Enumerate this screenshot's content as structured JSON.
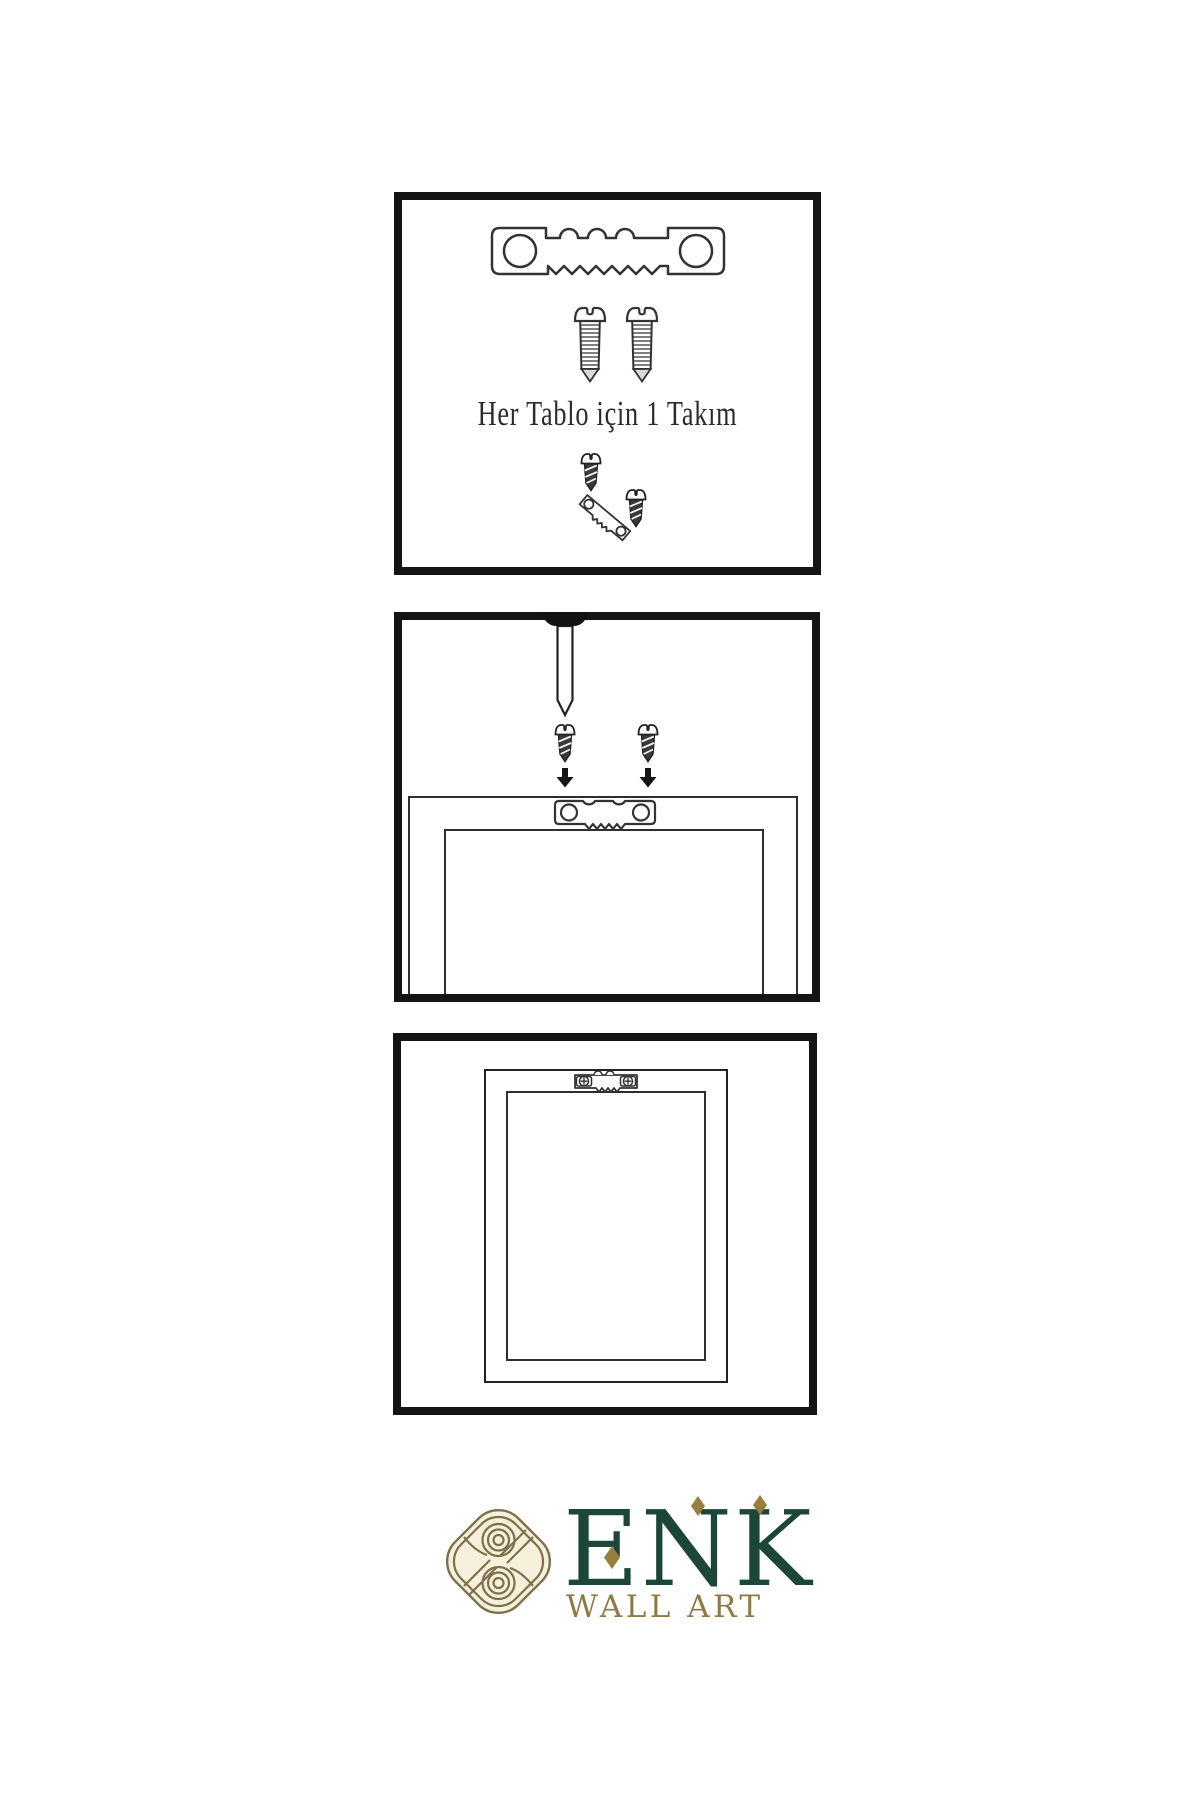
{
  "page": {
    "background": "#ffffff"
  },
  "colors": {
    "outline": "#333333",
    "panel_border": "#141414",
    "dark_fill": "#3a3a3a",
    "text": "#2b2b2b",
    "logo_green": "#1c4638",
    "logo_gold": "#8e7a43",
    "knot_gold": "#7d714a"
  },
  "steps": {
    "kit": {
      "caption": "Her Tablo için 1 Takım",
      "icons": [
        "sawtooth-hanger-icon",
        "screw-icon",
        "screw-icon",
        "screw-into-hanger-icon"
      ]
    },
    "mount": {
      "icons": [
        "nail-icon",
        "screw-icon",
        "screw-icon",
        "down-arrow-icon",
        "down-arrow-icon",
        "frame-back",
        "sawtooth-hanger-icon"
      ]
    },
    "hang": {
      "icons": [
        "frame-back",
        "sawtooth-hanger-icon"
      ]
    }
  },
  "logo": {
    "wordmark": "ENK",
    "tagline": "WALL ART"
  }
}
